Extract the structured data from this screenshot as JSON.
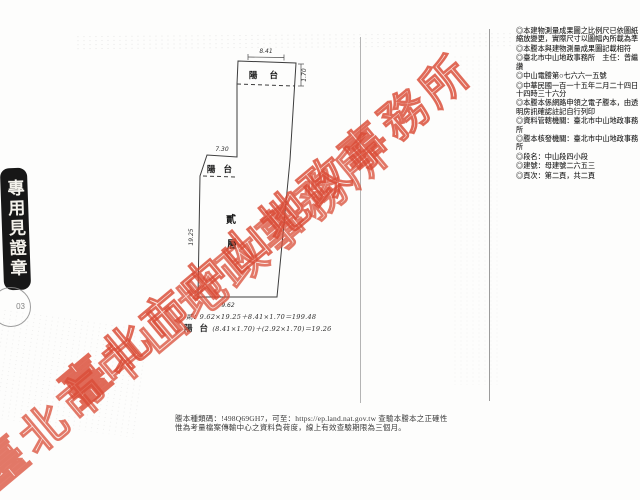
{
  "watermark": {
    "text": "臺北市中山地政事務所",
    "color": "#d94a34"
  },
  "stamps": {
    "side_text": "專用見證章",
    "round_number": "03"
  },
  "plan": {
    "floor_label": {
      "char1": "貳",
      "char2": "層"
    },
    "balcony_top_label": "陽 台",
    "balcony_mid_label": "陽 台",
    "dims": {
      "top": "8.41",
      "right": "1.70",
      "step": "7.30",
      "left": "19.25",
      "bottom": "9.62"
    },
    "formula1": "貳：9.62×19.25＋8.41×1.70＝199.48",
    "formula2_prefix": "陽 台",
    "formula2_body": "(8.41×1.70)＋(2.92×1.70)＝19.26"
  },
  "notes": [
    "◎本建物測量成果圖之比例尺已依圖紙縮放變更，實際尺寸以圖幅內所載為準",
    "◎本謄本與建物測量成果圖記載相符",
    "◎臺北市中山地政事務所　主任：曾繼讚",
    "◎中山電謄第○七六六一五號",
    "◎中華民國一百一十五年二月二十四日十四時三十六分",
    "◎本謄本係網路申領之電子謄本，由透明房訊確認註記自行列印",
    "◎資料管轄機關：臺北市中山地政事務所",
    "◎謄本核發機關：臺北市中山地政事務所",
    "◎段名：中山段四小段",
    "◎建號：母建號二六五三",
    "◎頁次：第二頁，共二頁"
  ],
  "footer": {
    "line1": "謄本種類碼：!498Q69GH7，可至：https://ep.land.nat.gov.tw 查驗本謄本之正確性",
    "line2": "惟為考量檔案傳輸中心之資料負荷度，線上有效查驗期限為三個月。"
  }
}
